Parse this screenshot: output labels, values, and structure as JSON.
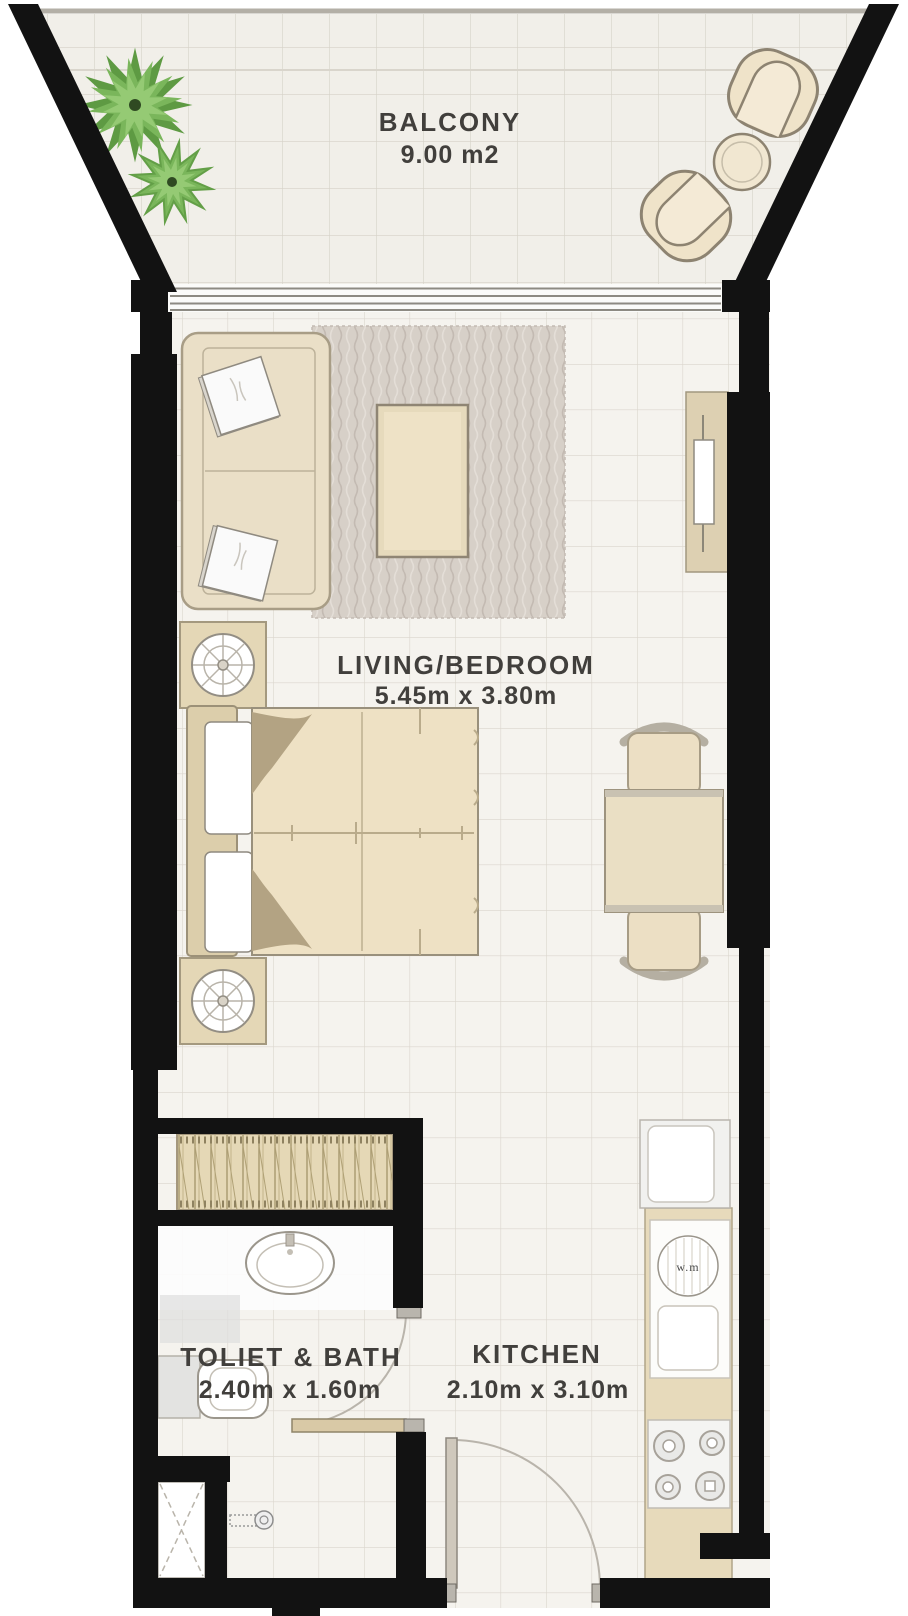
{
  "rooms": {
    "balcony": {
      "label": "BALCONY",
      "area": "9.00 m2"
    },
    "living_bedroom": {
      "label": "LIVING/BEDROOM",
      "size": "5.45m x 3.80m"
    },
    "toilet_bath": {
      "label": "TOLIET & BATH",
      "size": "2.40m x 1.60m"
    },
    "kitchen": {
      "label": "KITCHEN",
      "size": "2.10m x 3.10m"
    }
  },
  "appliances": {
    "washing_machine_label": "w.m"
  },
  "colors": {
    "wall": "#121212",
    "floor": "#f5f3ee",
    "floor_grid": "#dbd6cd",
    "furniture_fill": "#eadfc7",
    "furniture_outline": "#9a8f7b",
    "rug": "#d7d0c8",
    "wood": "#e5d8b6",
    "plant_green": "#6fae52",
    "label_text": "#413f3c",
    "white_fixture": "#ffffff"
  }
}
